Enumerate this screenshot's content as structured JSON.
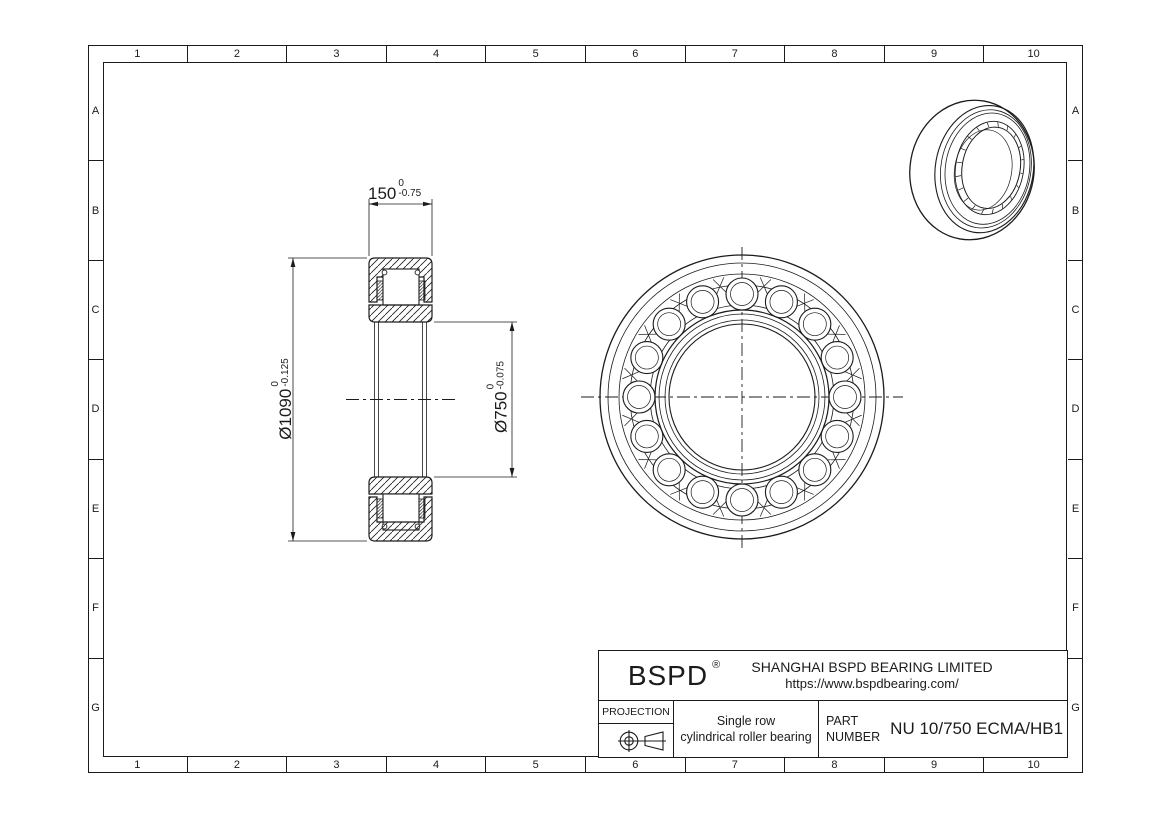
{
  "sheet": {
    "zone_numbers": [
      "1",
      "2",
      "3",
      "4",
      "5",
      "6",
      "7",
      "8",
      "9",
      "10"
    ],
    "zone_letters": [
      "A",
      "B",
      "C",
      "D",
      "E",
      "F",
      "G"
    ]
  },
  "dimensions": {
    "width": {
      "value": "150",
      "upper_tol": "0",
      "lower_tol": "-0.75"
    },
    "outer_diameter": {
      "value": "Ø1090",
      "upper_tol": "0",
      "lower_tol": "-0.125"
    },
    "bore_diameter": {
      "value": "Ø750",
      "upper_tol": "0",
      "lower_tol": "-0.075"
    }
  },
  "title_block": {
    "brand": "BSPD",
    "registered_mark": "®",
    "company": "SHANGHAI BSPD BEARING LIMITED",
    "website": "https://www.bspdbearing.com/",
    "projection_label": "PROJECTION",
    "projection_icon": "first-angle-projection-icon",
    "description_line1": "Single row",
    "description_line2": "cylindrical roller bearing",
    "part_label_line1": "PART",
    "part_label_line2": "NUMBER",
    "part_number": "NU 10/750 ECMA/HB1"
  },
  "drawing": {
    "line_color": "#1b1b1b",
    "background": "#ffffff",
    "views": [
      "section-view",
      "front-view",
      "isometric-view"
    ]
  }
}
